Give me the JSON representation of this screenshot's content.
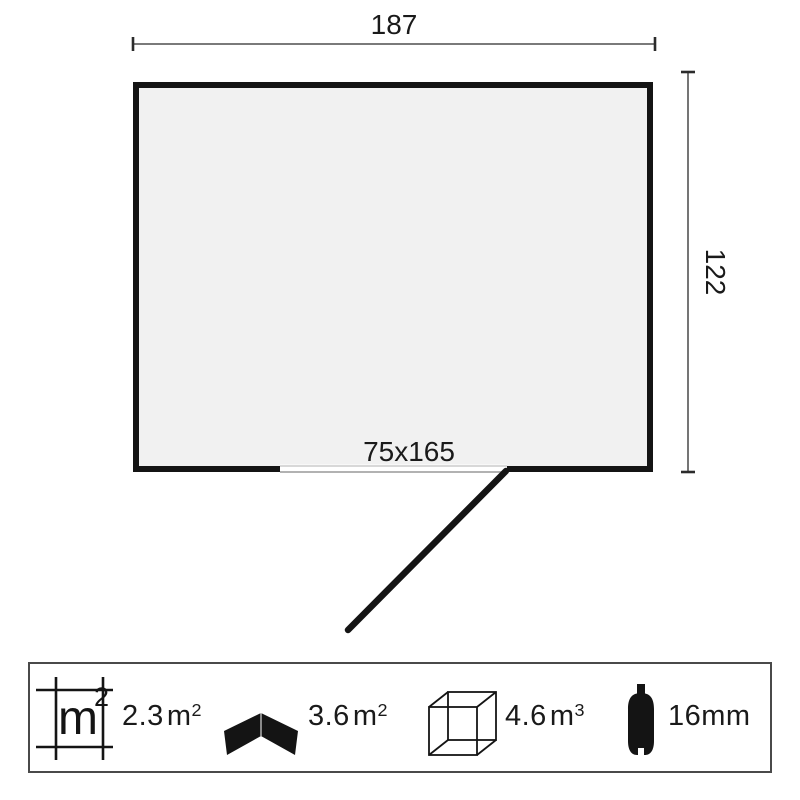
{
  "diagram": {
    "width_dim": "187",
    "height_dim": "122",
    "door_dim": "75x165"
  },
  "legend": {
    "area_icon_label": {
      "base": "m",
      "sup": "2"
    },
    "floor_area": {
      "value": "2.3",
      "unit_base": "m",
      "unit_sup": "2"
    },
    "roof_area": {
      "value": "3.6",
      "unit_base": "m",
      "unit_sup": "2"
    },
    "volume": {
      "value": "4.6",
      "unit_base": "m",
      "unit_sup": "3"
    },
    "wall_thickness": {
      "value": "16",
      "unit_base": "mm",
      "unit_sup": ""
    }
  },
  "icons": [
    "floor-area-grid-icon",
    "roof-chevron-icon",
    "volume-cube-icon",
    "wall-board-profile-icon"
  ],
  "colors": {
    "wall": "#141414",
    "plan_fill": "#f1f1f1",
    "dimension_line": "#2b2b2b",
    "threshold_light": "#cccccc",
    "threshold_dark": "#999999",
    "legend_border": "#4a4a4a",
    "background": "#ffffff"
  }
}
